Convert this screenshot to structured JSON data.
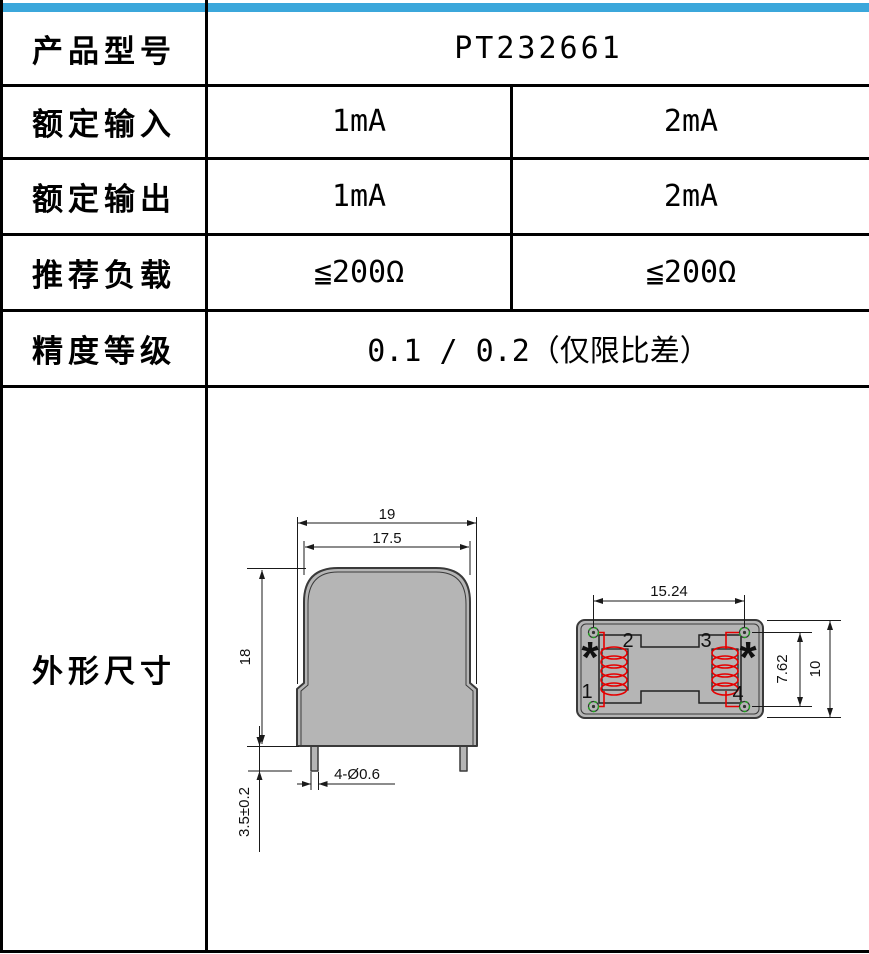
{
  "accent_color": "#3ba7db",
  "table": {
    "rows": [
      {
        "label": "产品型号",
        "values": [
          "PT232661"
        ]
      },
      {
        "label": "额定输入",
        "values": [
          "1mA",
          "2mA"
        ]
      },
      {
        "label": "额定输出",
        "values": [
          "1mA",
          "2mA"
        ]
      },
      {
        "label": "推荐负载",
        "values": [
          "≦200Ω",
          "≦200Ω"
        ]
      },
      {
        "label": "精度等级",
        "values": [
          "0.1 / 0.2（仅限比差）"
        ]
      },
      {
        "label": "外形尺寸",
        "values": []
      }
    ]
  },
  "drawing": {
    "front_view": {
      "dim_width_outer": "19",
      "dim_width_inner": "17.5",
      "dim_height": "18",
      "dim_pin_length": "3.5±0.2",
      "dim_pin_dia": "4-Ø0.6"
    },
    "top_view": {
      "dim_pin_pitch_h": "15.24",
      "dim_pin_pitch_v": "7.62",
      "dim_depth": "10",
      "pin_labels": [
        "1",
        "2",
        "3",
        "4"
      ],
      "polarity_mark": "*"
    },
    "colors": {
      "body_gray": "#b5b5b5",
      "outline": "#3a3a3a",
      "coil_red": "#e60000",
      "pin_green": "#1fa41f"
    }
  }
}
